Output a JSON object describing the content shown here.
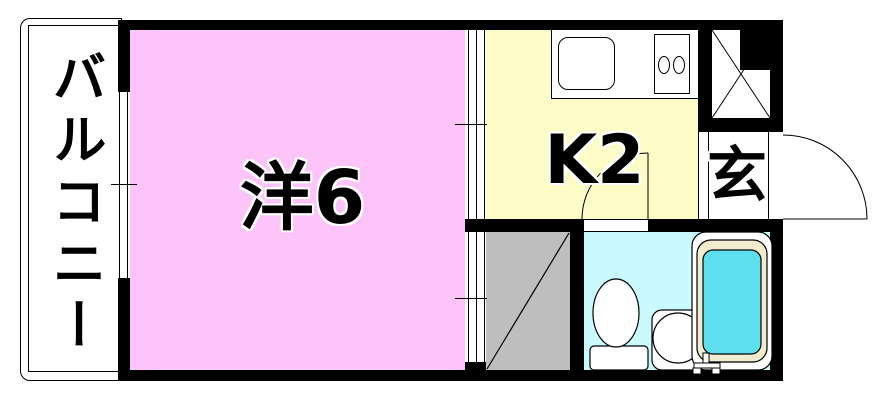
{
  "floor_plan": {
    "balcony": {
      "label": "バルコニー"
    },
    "living_room": {
      "label": "洋6",
      "color": "#FDC4FA"
    },
    "kitchen": {
      "label": "K2",
      "color": "#FEFCC6"
    },
    "entrance": {
      "label": "玄"
    },
    "closet": {
      "color": "#BEBEBE"
    },
    "bathroom": {
      "floor_color": "#C9FAFE",
      "bathtub_water_color": "#5EDFEE",
      "bathtub_rim_color": "#F1ECCE"
    },
    "wall_color": "#000000",
    "background_color": "#FFFFFF"
  }
}
